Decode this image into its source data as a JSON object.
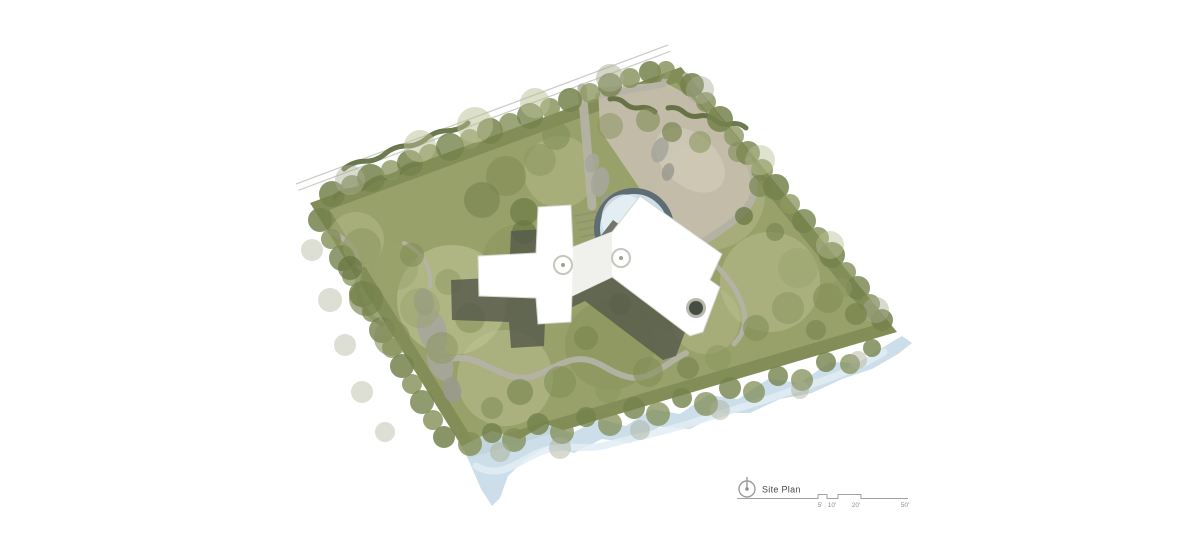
{
  "legend": {
    "title": "Site Plan",
    "scale_labels": [
      "5'",
      "10'",
      "20'",
      "50'"
    ]
  },
  "colors": {
    "background": "#ffffff",
    "road": "#cdcdc8",
    "site_base": "#98a169",
    "site_edge": "#6d7946",
    "stream": "#c8dbe7",
    "stream_highlight": "#e2edf4",
    "plaza": "#c3bdac",
    "plaza_light": "#d3cebd",
    "walk": "#b4b3a5",
    "rock": "#a7a69b",
    "rock_dark": "#9b9a90",
    "hedge": "#5d6a3c",
    "stair": "#8e8e7e",
    "pond_ring": "#5e6c74",
    "pond_water": "#cddfe9",
    "pond_glint": "#e9f1f6",
    "shadow": "#55594b",
    "building": "#ffffff",
    "building_edge": "#d6d6cf",
    "facet": "#f0f1ed",
    "skylight_ring": "#c7c6be",
    "skylight_dot": "#a09f95",
    "chimney_ring": "#b9b8ae",
    "chimney": "#484d43"
  },
  "scene": {
    "road": {
      "x1": 296,
      "y1": 184,
      "x2": 668,
      "y2": 45,
      "ox": 2.4,
      "oy": 6.3
    },
    "site": [
      [
        310,
        203
      ],
      [
        681,
        67
      ],
      [
        897,
        332
      ],
      [
        469,
        458
      ]
    ],
    "lawn_patches": [
      [
        452,
        300,
        55,
        "#c5c99d",
        0.5
      ],
      [
        505,
        378,
        48,
        "#c2c69a",
        0.45
      ],
      [
        560,
        172,
        36,
        "#c2c69a",
        0.35
      ],
      [
        770,
        282,
        50,
        "#bfc496",
        0.45
      ],
      [
        706,
        320,
        34,
        "#bfc496",
        0.35
      ],
      [
        356,
        240,
        28,
        "#c2c69a",
        0.35
      ],
      [
        710,
        195,
        55,
        "#b9bd92",
        0.45
      ],
      [
        610,
        345,
        45,
        "#7d8951",
        0.3
      ],
      [
        520,
        262,
        38,
        "#7d8951",
        0.25
      ],
      [
        668,
        300,
        30,
        "#7d8951",
        0.25
      ]
    ],
    "stream": {
      "poly": "462,446 492,431 520,439 546,424 572,433 600,419 626,426 652,409 680,414 708,395 738,399 768,379 800,383 830,362 858,363 880,349 902,336 912,343 898,354 872,369 842,379 812,393 780,399 750,413 720,413 690,429 660,427 630,443 602,439 574,453 550,445 526,459 508,476 500,498 492,506 481,489 472,468",
      "highlight": "M 476,466 C 500,480 516,462 540,452 C 566,442 584,452 610,444 C 640,436 664,432 694,422 C 724,412 756,404 788,392 C 820,382 852,372 884,352"
    },
    "plaza": {
      "points": "598,88 664,82 690,96 742,150 758,186 736,216 700,240 666,226 638,186 600,130",
      "inner": [
        690,
        160,
        40,
        26,
        40
      ]
    },
    "walks": [
      {
        "d": "M 582,88 L 592,206",
        "w": 9
      },
      {
        "d": "M 686,76 C 698,96 716,118 736,142 C 754,163 760,190 748,206 C 736,222 714,236 692,248",
        "w": 7
      },
      {
        "d": "M 694,250 C 716,262 734,282 742,304 C 748,320 744,334 734,344",
        "w": 5
      },
      {
        "d": "M 442,362 C 468,350 486,368 510,376 C 534,384 548,366 572,360 C 596,355 606,372 628,377 C 650,382 664,364 686,353",
        "w": 6
      },
      {
        "d": "M 330,232 C 352,240 362,257 358,276 C 354,296 364,314 382,324",
        "w": 5
      },
      {
        "d": "M 404,243 C 422,252 432,268 430,286",
        "w": 4
      },
      {
        "d": "M 690,256 C 698,278 700,302 692,326",
        "w": 4.5
      },
      {
        "d": "M 598,96 L 664,84",
        "w": 6
      },
      {
        "d": "M 662,84 L 668,74",
        "w": 5
      }
    ],
    "rocks": [
      [
        432,
        330,
        14,
        24,
        -18,
        "#a7a69b",
        0.95
      ],
      [
        424,
        302,
        10,
        14,
        -10,
        "#9b9a90",
        0.9
      ],
      [
        440,
        362,
        12,
        20,
        -22,
        "#a7a69b",
        0.9
      ],
      [
        452,
        390,
        9,
        13,
        -15,
        "#9b9a90",
        0.85
      ],
      [
        600,
        182,
        9,
        15,
        12,
        "#a7a69b",
        0.9
      ],
      [
        608,
        204,
        7,
        11,
        8,
        "#9b9a90",
        0.85
      ],
      [
        592,
        163,
        7,
        10,
        15,
        "#a7a69b",
        0.85
      ],
      [
        660,
        150,
        8,
        13,
        20,
        "#a7a69b",
        0.9
      ],
      [
        668,
        172,
        6,
        9,
        15,
        "#9b9a90",
        0.85
      ]
    ],
    "hedges": [
      {
        "p": [
          344,
          169,
          468,
          123
        ],
        "n": 6,
        "a": 4
      },
      {
        "p": [
          335,
          197,
          418,
          164
        ],
        "n": 5,
        "a": 3.5
      },
      {
        "p": [
          610,
          99,
          655,
          112
        ],
        "n": 3,
        "a": 4
      },
      {
        "p": [
          668,
          108,
          746,
          128
        ],
        "n": 5,
        "a": 4
      }
    ],
    "tree_palette": [
      "#66743f",
      "#76824c",
      "#828e56",
      "#8d9861",
      "#9aa46e",
      "#aab279",
      "#b9bf94",
      "#a9ae94"
    ],
    "trees": [
      [
        332,
        194,
        13,
        1,
        0.85
      ],
      [
        352,
        186,
        11,
        2,
        0.8
      ],
      [
        371,
        178,
        14,
        1,
        0.85
      ],
      [
        391,
        170,
        10,
        3,
        0.8
      ],
      [
        410,
        163,
        13,
        1,
        0.85
      ],
      [
        430,
        155,
        11,
        2,
        0.8
      ],
      [
        450,
        147,
        14,
        1,
        0.8
      ],
      [
        470,
        139,
        10,
        3,
        0.8
      ],
      [
        490,
        131,
        13,
        1,
        0.85
      ],
      [
        510,
        124,
        11,
        2,
        0.8
      ],
      [
        530,
        116,
        13,
        1,
        0.8
      ],
      [
        550,
        108,
        10,
        2,
        0.8
      ],
      [
        570,
        100,
        12,
        1,
        0.85
      ],
      [
        590,
        93,
        10,
        3,
        0.8
      ],
      [
        610,
        85,
        12,
        1,
        0.8
      ],
      [
        630,
        78,
        10,
        2,
        0.8
      ],
      [
        650,
        72,
        11,
        1,
        0.85
      ],
      [
        666,
        70,
        9,
        2,
        0.8
      ],
      [
        420,
        146,
        16,
        6,
        0.5
      ],
      [
        475,
        125,
        18,
        6,
        0.5
      ],
      [
        535,
        103,
        15,
        6,
        0.5
      ],
      [
        610,
        78,
        14,
        7,
        0.5
      ],
      [
        350,
        180,
        15,
        7,
        0.45
      ],
      [
        692,
        85,
        12,
        1,
        0.85
      ],
      [
        706,
        102,
        10,
        2,
        0.8
      ],
      [
        720,
        119,
        13,
        1,
        0.85
      ],
      [
        734,
        136,
        10,
        3,
        0.8
      ],
      [
        748,
        153,
        12,
        1,
        0.8
      ],
      [
        762,
        170,
        11,
        2,
        0.8
      ],
      [
        776,
        187,
        13,
        1,
        0.85
      ],
      [
        790,
        204,
        10,
        3,
        0.8
      ],
      [
        804,
        221,
        12,
        1,
        0.8
      ],
      [
        818,
        238,
        11,
        2,
        0.8
      ],
      [
        832,
        255,
        13,
        1,
        0.85
      ],
      [
        846,
        272,
        10,
        2,
        0.8
      ],
      [
        858,
        288,
        12,
        1,
        0.8
      ],
      [
        870,
        304,
        10,
        2,
        0.8
      ],
      [
        882,
        320,
        11,
        1,
        0.85
      ],
      [
        700,
        90,
        14,
        7,
        0.45
      ],
      [
        760,
        160,
        15,
        6,
        0.45
      ],
      [
        830,
        245,
        14,
        6,
        0.45
      ],
      [
        876,
        310,
        13,
        7,
        0.45
      ],
      [
        320,
        220,
        12,
        1,
        0.85
      ],
      [
        331,
        239,
        10,
        2,
        0.8
      ],
      [
        342,
        258,
        13,
        1,
        0.8
      ],
      [
        352,
        276,
        10,
        3,
        0.8
      ],
      [
        362,
        294,
        13,
        1,
        0.85
      ],
      [
        372,
        312,
        10,
        2,
        0.8
      ],
      [
        382,
        330,
        13,
        1,
        0.8
      ],
      [
        392,
        348,
        10,
        3,
        0.8
      ],
      [
        402,
        366,
        12,
        1,
        0.85
      ],
      [
        412,
        384,
        10,
        2,
        0.8
      ],
      [
        422,
        402,
        12,
        1,
        0.8
      ],
      [
        433,
        420,
        10,
        2,
        0.8
      ],
      [
        444,
        437,
        11,
        1,
        0.85
      ],
      [
        312,
        250,
        11,
        7,
        0.4
      ],
      [
        330,
        300,
        12,
        7,
        0.4
      ],
      [
        345,
        345,
        11,
        7,
        0.4
      ],
      [
        362,
        392,
        11,
        7,
        0.4
      ],
      [
        385,
        432,
        10,
        7,
        0.4
      ],
      [
        470,
        444,
        12,
        2,
        0.8
      ],
      [
        492,
        433,
        10,
        1,
        0.8
      ],
      [
        514,
        440,
        12,
        2,
        0.75
      ],
      [
        538,
        424,
        11,
        1,
        0.8
      ],
      [
        562,
        432,
        12,
        2,
        0.75
      ],
      [
        586,
        417,
        10,
        1,
        0.8
      ],
      [
        610,
        424,
        12,
        2,
        0.75
      ],
      [
        634,
        408,
        11,
        1,
        0.8
      ],
      [
        658,
        414,
        12,
        2,
        0.75
      ],
      [
        682,
        398,
        10,
        1,
        0.8
      ],
      [
        706,
        404,
        12,
        2,
        0.75
      ],
      [
        730,
        388,
        11,
        1,
        0.8
      ],
      [
        754,
        392,
        11,
        2,
        0.75
      ],
      [
        778,
        376,
        10,
        1,
        0.8
      ],
      [
        802,
        380,
        11,
        2,
        0.75
      ],
      [
        826,
        362,
        10,
        1,
        0.8
      ],
      [
        850,
        364,
        10,
        2,
        0.75
      ],
      [
        872,
        348,
        9,
        1,
        0.8
      ],
      [
        500,
        452,
        10,
        7,
        0.5
      ],
      [
        560,
        448,
        11,
        7,
        0.45
      ],
      [
        640,
        430,
        10,
        7,
        0.45
      ],
      [
        720,
        410,
        10,
        7,
        0.45
      ],
      [
        800,
        390,
        9,
        7,
        0.45
      ],
      [
        858,
        360,
        9,
        7,
        0.45
      ],
      [
        362,
        247,
        19,
        3,
        0.6
      ],
      [
        396,
        268,
        22,
        4,
        0.55
      ],
      [
        366,
        299,
        17,
        1,
        0.65
      ],
      [
        420,
        308,
        20,
        4,
        0.5
      ],
      [
        392,
        338,
        18,
        2,
        0.6
      ],
      [
        442,
        348,
        16,
        3,
        0.55
      ],
      [
        470,
        318,
        15,
        2,
        0.5
      ],
      [
        350,
        268,
        12,
        0,
        0.7
      ],
      [
        412,
        255,
        12,
        2,
        0.6
      ],
      [
        448,
        282,
        13,
        3,
        0.5
      ],
      [
        506,
        176,
        20,
        2,
        0.65
      ],
      [
        540,
        160,
        16,
        3,
        0.6
      ],
      [
        482,
        200,
        18,
        1,
        0.6
      ],
      [
        556,
        136,
        14,
        2,
        0.6
      ],
      [
        524,
        212,
        14,
        0,
        0.6
      ],
      [
        610,
        126,
        13,
        3,
        0.55
      ],
      [
        648,
        120,
        12,
        2,
        0.6
      ],
      [
        672,
        132,
        10,
        1,
        0.65
      ],
      [
        700,
        142,
        11,
        3,
        0.6
      ],
      [
        738,
        152,
        10,
        2,
        0.6
      ],
      [
        760,
        186,
        11,
        1,
        0.65
      ],
      [
        744,
        216,
        9,
        0,
        0.7
      ],
      [
        775,
        232,
        9,
        1,
        0.6
      ],
      [
        798,
        268,
        20,
        4,
        0.55
      ],
      [
        828,
        298,
        15,
        2,
        0.65
      ],
      [
        856,
        314,
        11,
        1,
        0.7
      ],
      [
        788,
        308,
        16,
        3,
        0.55
      ],
      [
        756,
        328,
        13,
        2,
        0.6
      ],
      [
        816,
        330,
        10,
        1,
        0.6
      ],
      [
        842,
        288,
        10,
        3,
        0.55
      ],
      [
        560,
        382,
        16,
        2,
        0.6
      ],
      [
        608,
        390,
        13,
        3,
        0.55
      ],
      [
        648,
        372,
        15,
        2,
        0.6
      ],
      [
        688,
        368,
        11,
        1,
        0.6
      ],
      [
        718,
        358,
        13,
        3,
        0.55
      ],
      [
        520,
        392,
        13,
        1,
        0.6
      ],
      [
        492,
        408,
        11,
        2,
        0.6
      ],
      [
        524,
        232,
        12,
        0,
        0.6
      ],
      [
        620,
        304,
        11,
        0,
        0.55
      ],
      [
        586,
        338,
        12,
        1,
        0.55
      ],
      [
        656,
        252,
        9,
        0,
        0.65
      ]
    ],
    "stairs": [
      [
        574,
        216,
        597,
        212
      ],
      [
        576,
        223,
        599,
        219
      ],
      [
        578,
        230,
        601,
        226
      ],
      [
        580,
        237,
        603,
        233
      ],
      [
        582,
        244,
        605,
        240
      ],
      [
        584,
        251,
        607,
        247
      ]
    ],
    "pond": {
      "cx": 634,
      "cy": 228,
      "r": 37,
      "ring": 6,
      "glint": [
        626,
        222,
        24,
        28,
        -20
      ]
    },
    "building": {
      "points": "538,207 571,205 573,247 612,232 640,196 722,254 710,280 720,287 703,332 690,336 612,277 572,296 571,322 538,324 536,298 479,296 478,256 536,253",
      "shadow_dx": -27,
      "shadow_dy": 24,
      "facet": "573,247 612,232 612,277 572,296",
      "skylights": [
        [
          563,
          265
        ],
        [
          621,
          258
        ]
      ],
      "chimney": [
        696,
        308
      ]
    }
  }
}
